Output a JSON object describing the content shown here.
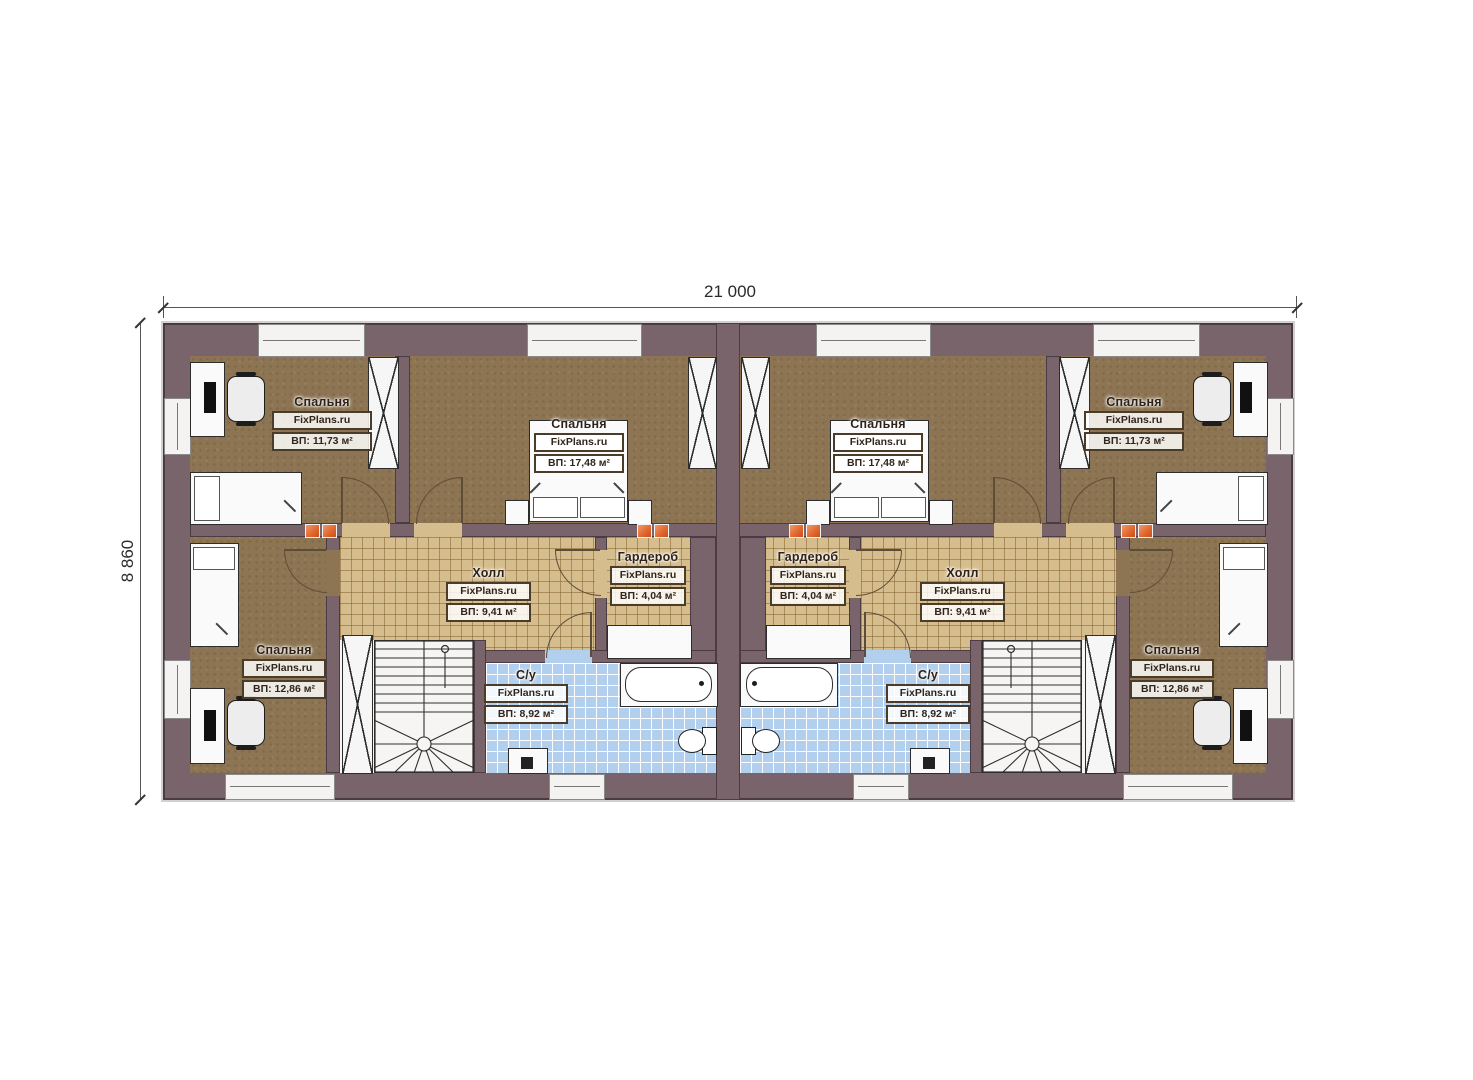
{
  "watermark": "FixPlans.ru",
  "dimensions": {
    "width_label": "21 000",
    "height_label": "8 860"
  },
  "rooms": [
    {
      "key": "bedroom-top-left",
      "name": "Спальня",
      "area": "ВП: 11,73 м²"
    },
    {
      "key": "bedroom-center-left",
      "name": "Спальня",
      "area": "ВП: 17,48 м²"
    },
    {
      "key": "bedroom-bottom-left",
      "name": "Спальня",
      "area": "ВП: 12,86 м²"
    },
    {
      "key": "hall-left",
      "name": "Холл",
      "area": "ВП: 9,41 м²"
    },
    {
      "key": "wardrobe-left",
      "name": "Гардероб",
      "area": "ВП: 4,04 м²"
    },
    {
      "key": "bathroom-left",
      "name": "С/у",
      "area": "ВП: 8,92 м²"
    },
    {
      "key": "bedroom-center-right",
      "name": "Спальня",
      "area": "ВП: 17,48 м²"
    },
    {
      "key": "bedroom-top-right",
      "name": "Спальня",
      "area": "ВП: 11,73 м²"
    },
    {
      "key": "bedroom-bottom-right",
      "name": "Спальня",
      "area": "ВП: 12,86 м²"
    },
    {
      "key": "hall-right",
      "name": "Холл",
      "area": "ВП: 9,41 м²"
    },
    {
      "key": "wardrobe-right",
      "name": "Гардероб",
      "area": "ВП: 4,04 м²"
    },
    {
      "key": "bathroom-right",
      "name": "С/у",
      "area": "ВП: 8,92 м²"
    }
  ],
  "colors": {
    "wall": "#7a646b",
    "wall_outline": "#4a3c42",
    "bedroom_floor": "#8d7553",
    "hall_tile": "#d6bd8d",
    "bath_tile": "#b2d0ee",
    "stair_floor": "#f6f5f3",
    "vent_orange": "#e2692f",
    "door_line": "#5f4c38"
  }
}
